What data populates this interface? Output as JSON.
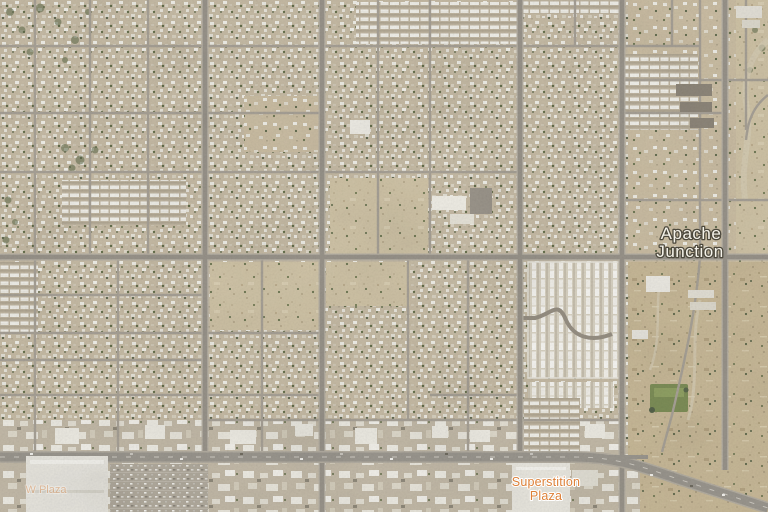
{
  "view": {
    "mode": "satellite-imagery"
  },
  "labels": {
    "city": {
      "line1": "Apache",
      "line2": "Junction",
      "text_color": "#f5f3ea",
      "halo_color": "#4c483c"
    },
    "shopping_poi": {
      "line1": "Superstition",
      "line2": "Plaza",
      "text_color": "#dd8038",
      "halo_color": "#ffffff"
    },
    "faint_poi": {
      "text": "W Plaza",
      "text_color": "#dd8038",
      "halo_color": "#ffffff",
      "opacity": "0.38"
    }
  },
  "palette": {
    "desert_base": "#cbbfa8",
    "urban_block": "#c6bba5",
    "open_desert": "#cfc3a6",
    "rough_desert": "#c7b897",
    "minor_road": "#a7a196",
    "major_road": "#98938a",
    "highway": "#9a968e",
    "rooftop_white": "#ebe9e1",
    "rooftop_dark": "#8d8679",
    "vegetation": "#5e6a4a",
    "park_green": "#7c8d57",
    "parking_lot": "#b1aa9d"
  }
}
